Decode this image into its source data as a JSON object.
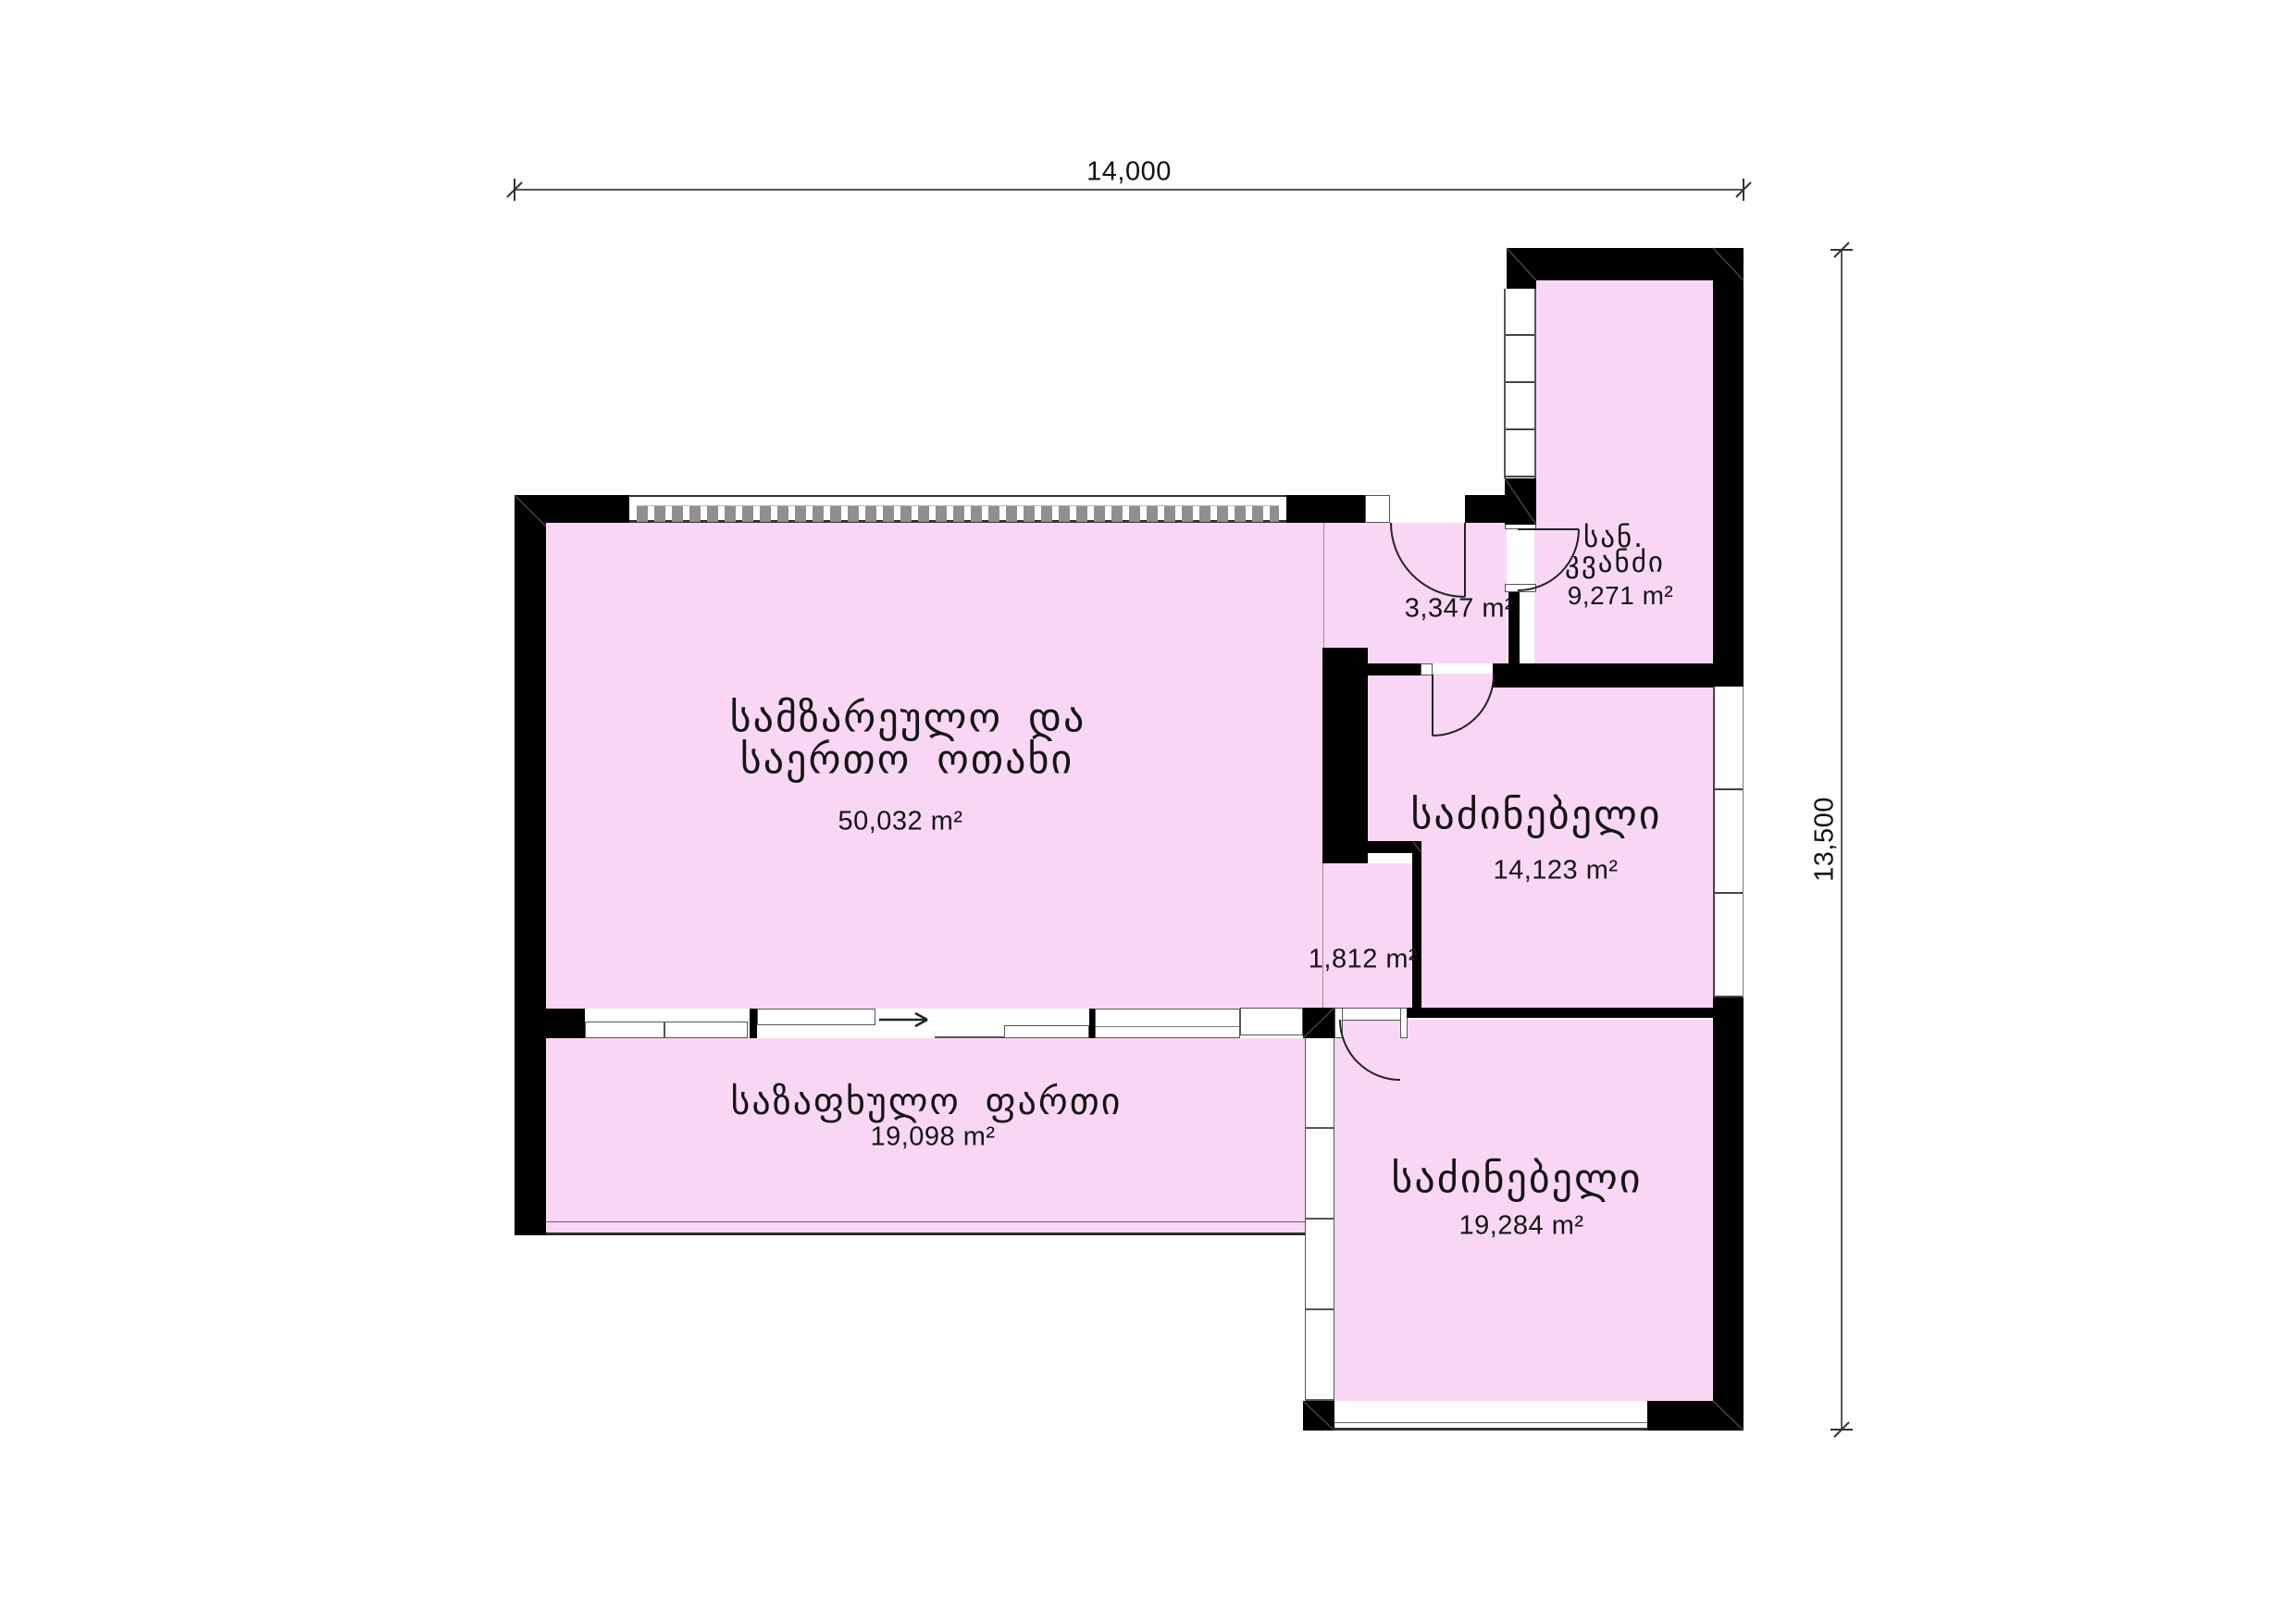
{
  "drawing": {
    "kind": "apartment floor plan",
    "dimensions": {
      "top_width_label": "14,000",
      "right_height_label": "13,500"
    },
    "rooms": {
      "kitchen_living": {
        "name_line1": "სამზარეულო და",
        "name_line2": "საერთო ოთახი",
        "area": "50,032 m²"
      },
      "hallway": {
        "area": "3,347 m²"
      },
      "bathroom": {
        "name_line1": "სან.",
        "name_line2": "კვანძი",
        "area": "9,271 m²"
      },
      "bedroom1": {
        "name": "საძინებელი",
        "area": "14,123 m²"
      },
      "closet": {
        "area": "1,812 m²"
      },
      "summer_space": {
        "name": "საზაფხულო ფართი",
        "area": "19,098 m²"
      },
      "bedroom2": {
        "name": "საძინებელი",
        "area": "19,284 m²"
      }
    },
    "colors": {
      "room_fill": "#F9D7F4",
      "wall": "#000000",
      "line_dark": "#333333",
      "line_mid": "#555555",
      "window_hatch": "#8f8f8f"
    },
    "icons": {
      "entrance_arrow": "right-arrow"
    }
  }
}
